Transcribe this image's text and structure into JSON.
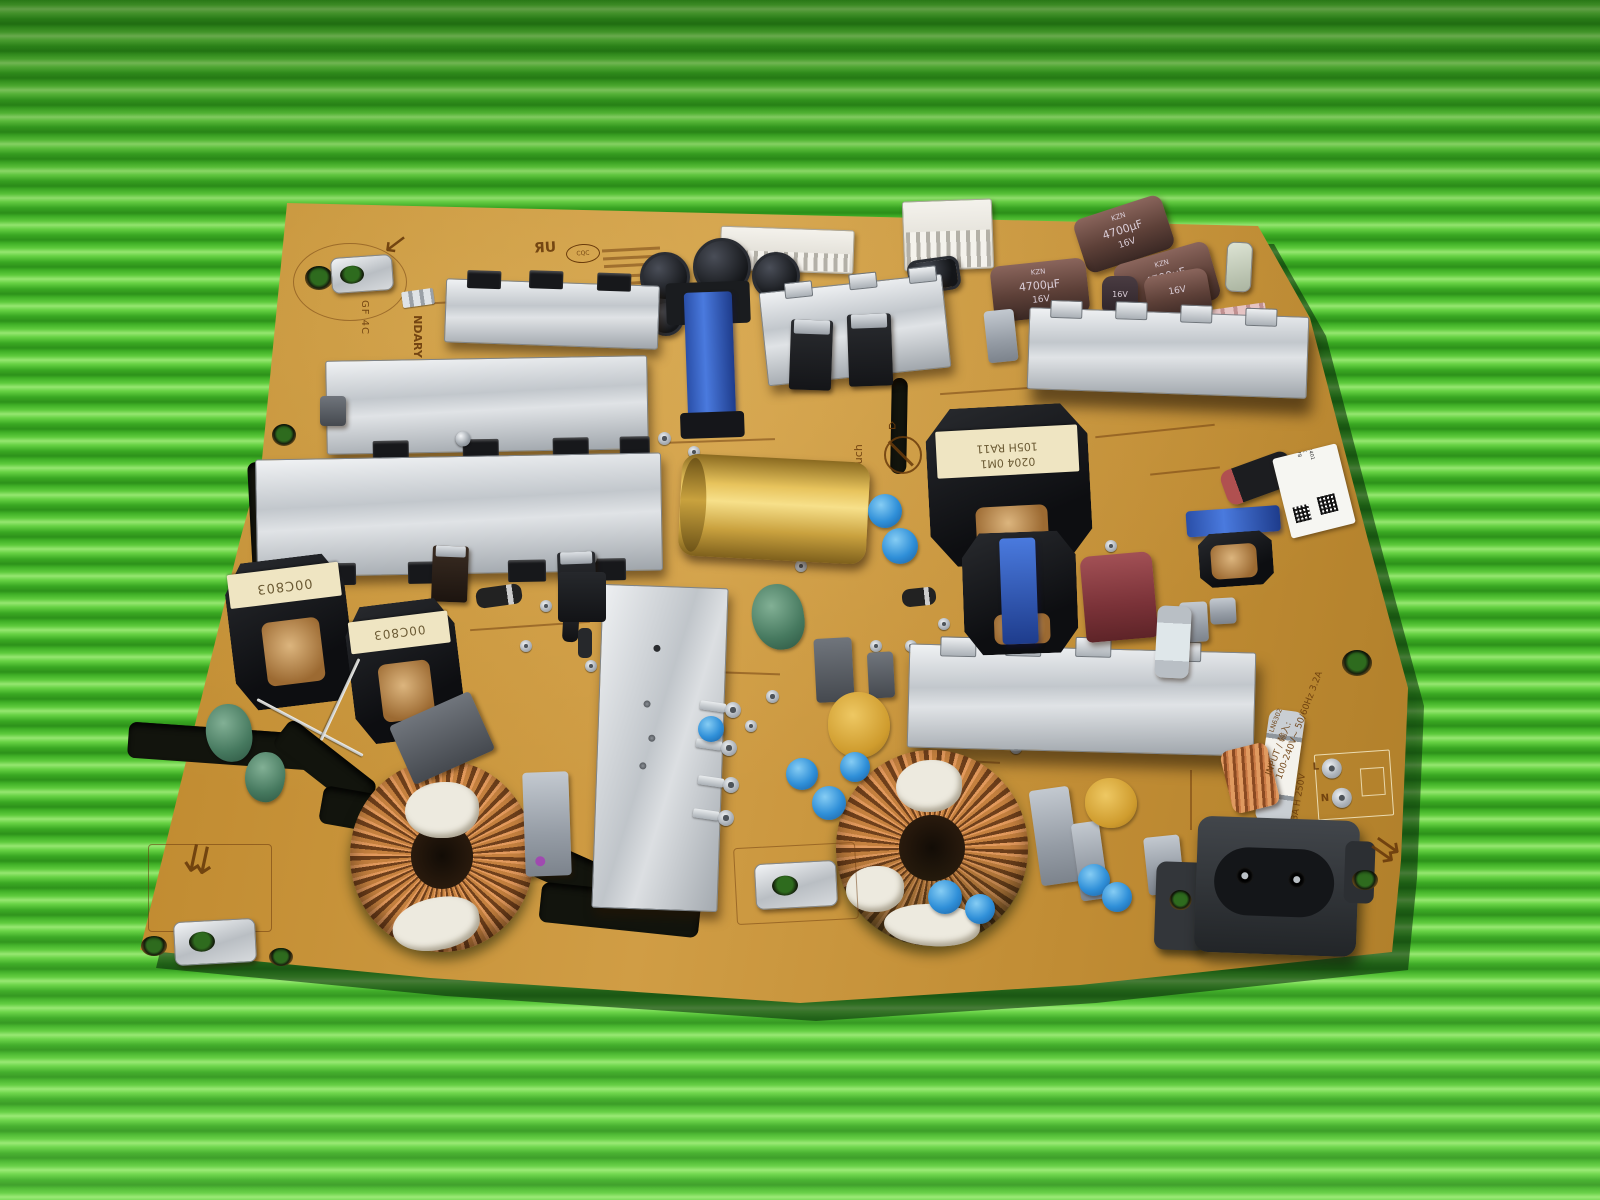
{
  "scene": {
    "subject": "TV power supply PCB photographed on a green corrugated mat",
    "mat_green_light": "#67d33f",
    "mat_green_dark": "#2f9a1e",
    "pcb_amber": "#c8923a"
  },
  "silkscreen": {
    "dont_touch": "Don't Touch",
    "secondary_partial": "NDARY",
    "gf_mark": "GF 4C",
    "live": "L",
    "neutral": "N",
    "fuse_rating": "6.3A H 250V",
    "fuse_ref": "LN6302",
    "input_label": "INPUT / 輸入:",
    "input_rating": "100-240V~ 50/60Hz 3.2A",
    "cert_ul": "ЯU",
    "cert_cqc": "CQC"
  },
  "icons": {
    "house": "⌂",
    "double_down_arrow": "⇊",
    "corner_arrow_down_left": "↙",
    "corner_arrow_down_right": "↘"
  },
  "components": {
    "choke_label": "00C803",
    "main_tx_line1": "0204 0M1",
    "main_tx_line2": "105H RA11",
    "cap_series": "KZN",
    "cap_capacity": "4700µF",
    "cap_voltage": "16V",
    "small_cap_voltage": "16V",
    "sticker": {
      "lines": [
        "DGP",
        "ACD-2401",
        "100B-24NX",
        "2104040378"
      ]
    }
  }
}
